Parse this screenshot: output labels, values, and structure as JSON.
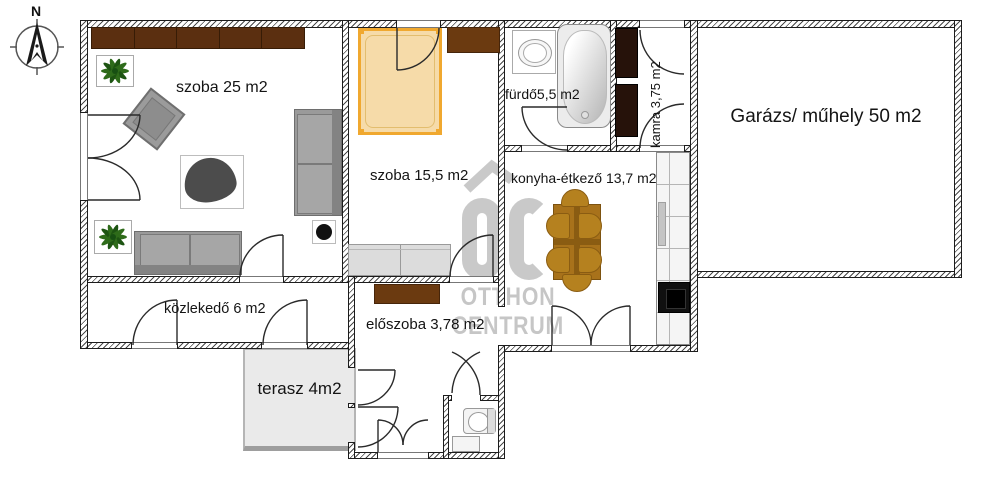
{
  "compass": {
    "north_label": "N"
  },
  "rooms": {
    "szoba25": {
      "label": "szoba 25 m2"
    },
    "szoba155": {
      "label": "szoba 15,5 m2"
    },
    "furdo": {
      "label": "fürdő5,5 m2"
    },
    "kamra": {
      "label": "kamra 3,75 m2"
    },
    "garazs": {
      "label": "Garázs/ műhely 50 m2"
    },
    "konyha": {
      "label": "konyha-étkező 13,7 m2"
    },
    "kozlekedo": {
      "label": "közlekedő 6 m2"
    },
    "eloszoba": {
      "label": "előszoba 3,78 m2"
    },
    "terasz": {
      "label": "terasz 4m2"
    }
  },
  "watermark": {
    "logo_text": "ÓC",
    "line1": "OTTHON",
    "line2": "CENTRUM"
  },
  "colors": {
    "wall_line": "#1c1c1c",
    "cabinet_brown": "#5b2f10",
    "pantry_cabinet": "#26120a",
    "bed_fill": "#f6dba9",
    "bed_frame": "#f0a82f",
    "dining_wood": "#b5811f",
    "sofa_gray": "#9a9a9a",
    "terrace_gray": "#eaeaea",
    "watermark_gray": "#c9c9c9"
  }
}
